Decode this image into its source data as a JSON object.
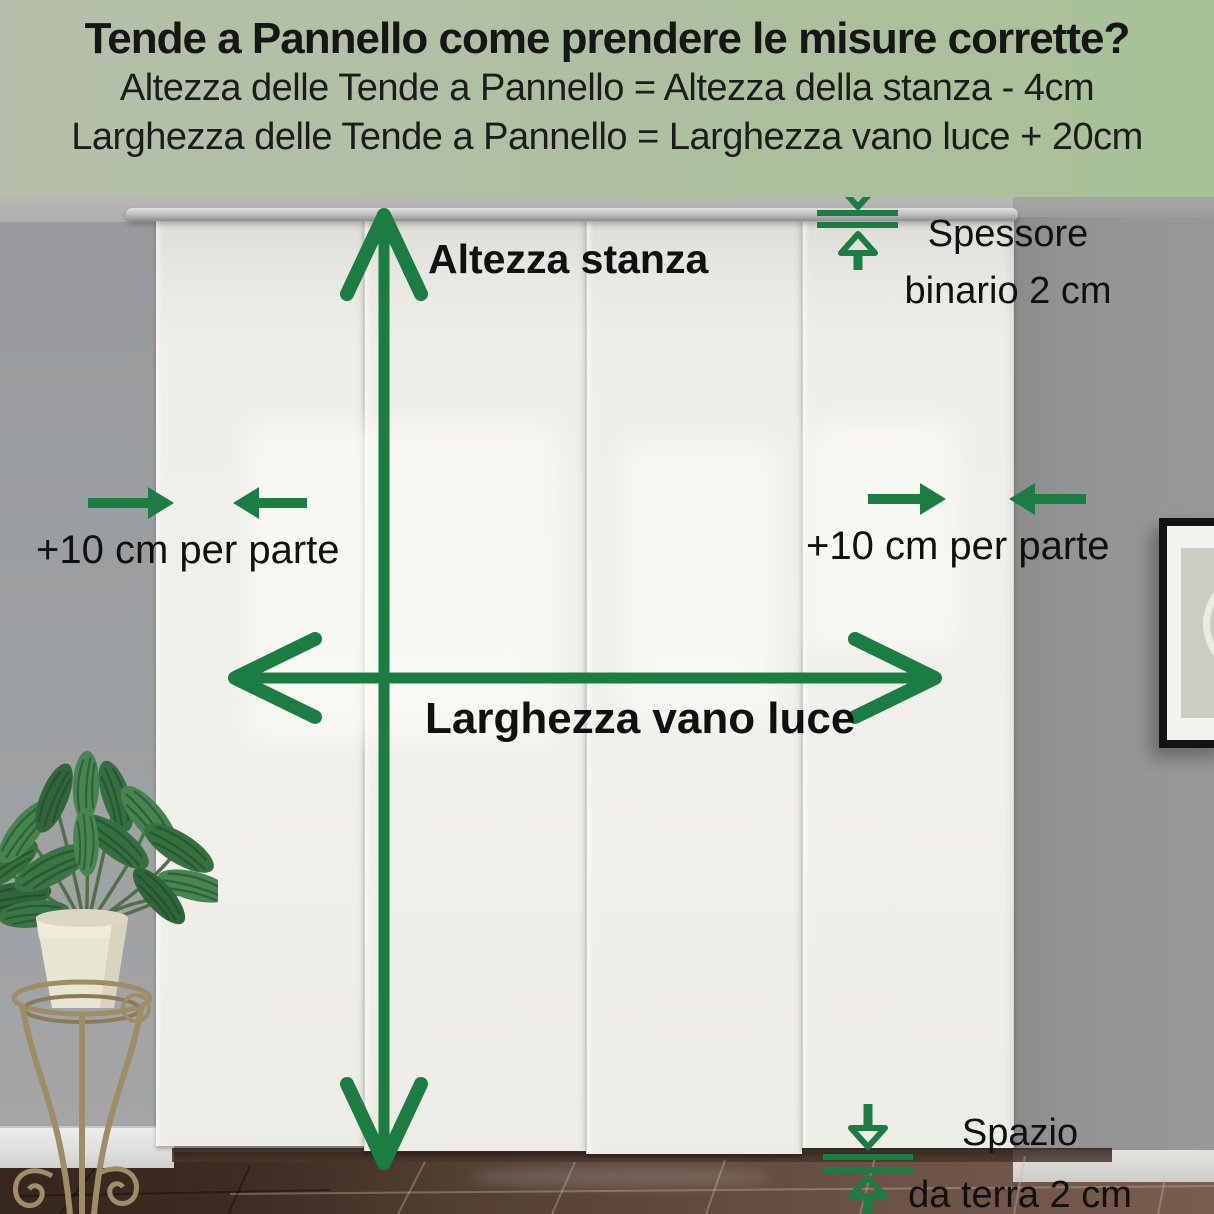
{
  "header": {
    "title": "Tende a Pannello come prendere le misure corrette?",
    "formula_height": "Altezza delle Tende a Pannello = Altezza della stanza - 4cm",
    "formula_width": "Larghezza delle Tende a Pannello = Larghezza vano luce + 20cm"
  },
  "annotations": {
    "room_height": "Altezza stanza",
    "opening_width": "Larghezza vano luce",
    "left_margin": "+10 cm per parte",
    "right_margin": "+10 cm per parte",
    "track_thickness_line1": "Spessore",
    "track_thickness_line2": "binario 2 cm",
    "floor_gap_line1": "Spazio",
    "floor_gap_line2": "da terra 2 cm"
  },
  "colors": {
    "accent_green": "#1b7d42",
    "header_background_left": "#b6bfab",
    "header_background_right": "#a8c196",
    "curtain": "#f1f0ea",
    "wall_gray": "#9b9d9f",
    "floor_brown": "#5a4439"
  },
  "scene": {
    "curtain_panels": 4,
    "decor": [
      "potted-plant",
      "plant-stand",
      "picture-frame",
      "curtain-track"
    ]
  }
}
